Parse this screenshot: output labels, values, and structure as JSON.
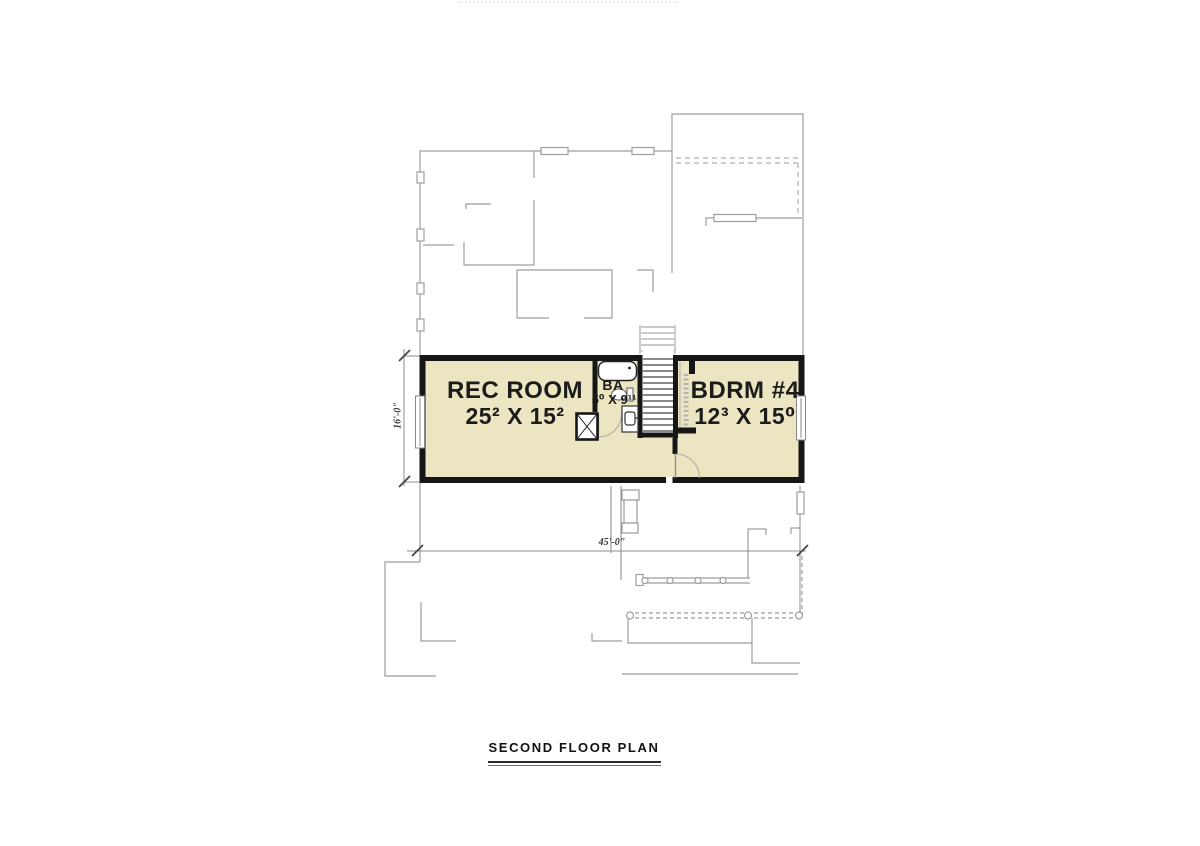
{
  "drawing": {
    "title": "SECOND FLOOR PLAN",
    "rooms": [
      {
        "name": "REC ROOM",
        "size": "25² X 15²"
      },
      {
        "name": "BA",
        "size": "5⁰ X 9¹¹"
      },
      {
        "name": "BDRM #4",
        "size": "12³ X 15⁰"
      }
    ],
    "dimensions": {
      "overall_width": "45'-0\"",
      "overall_depth": "16'-0\""
    },
    "colors": {
      "room_fill": "#ECE5C2",
      "wall": "#161616",
      "faded_line": "#9E9E9E"
    }
  }
}
